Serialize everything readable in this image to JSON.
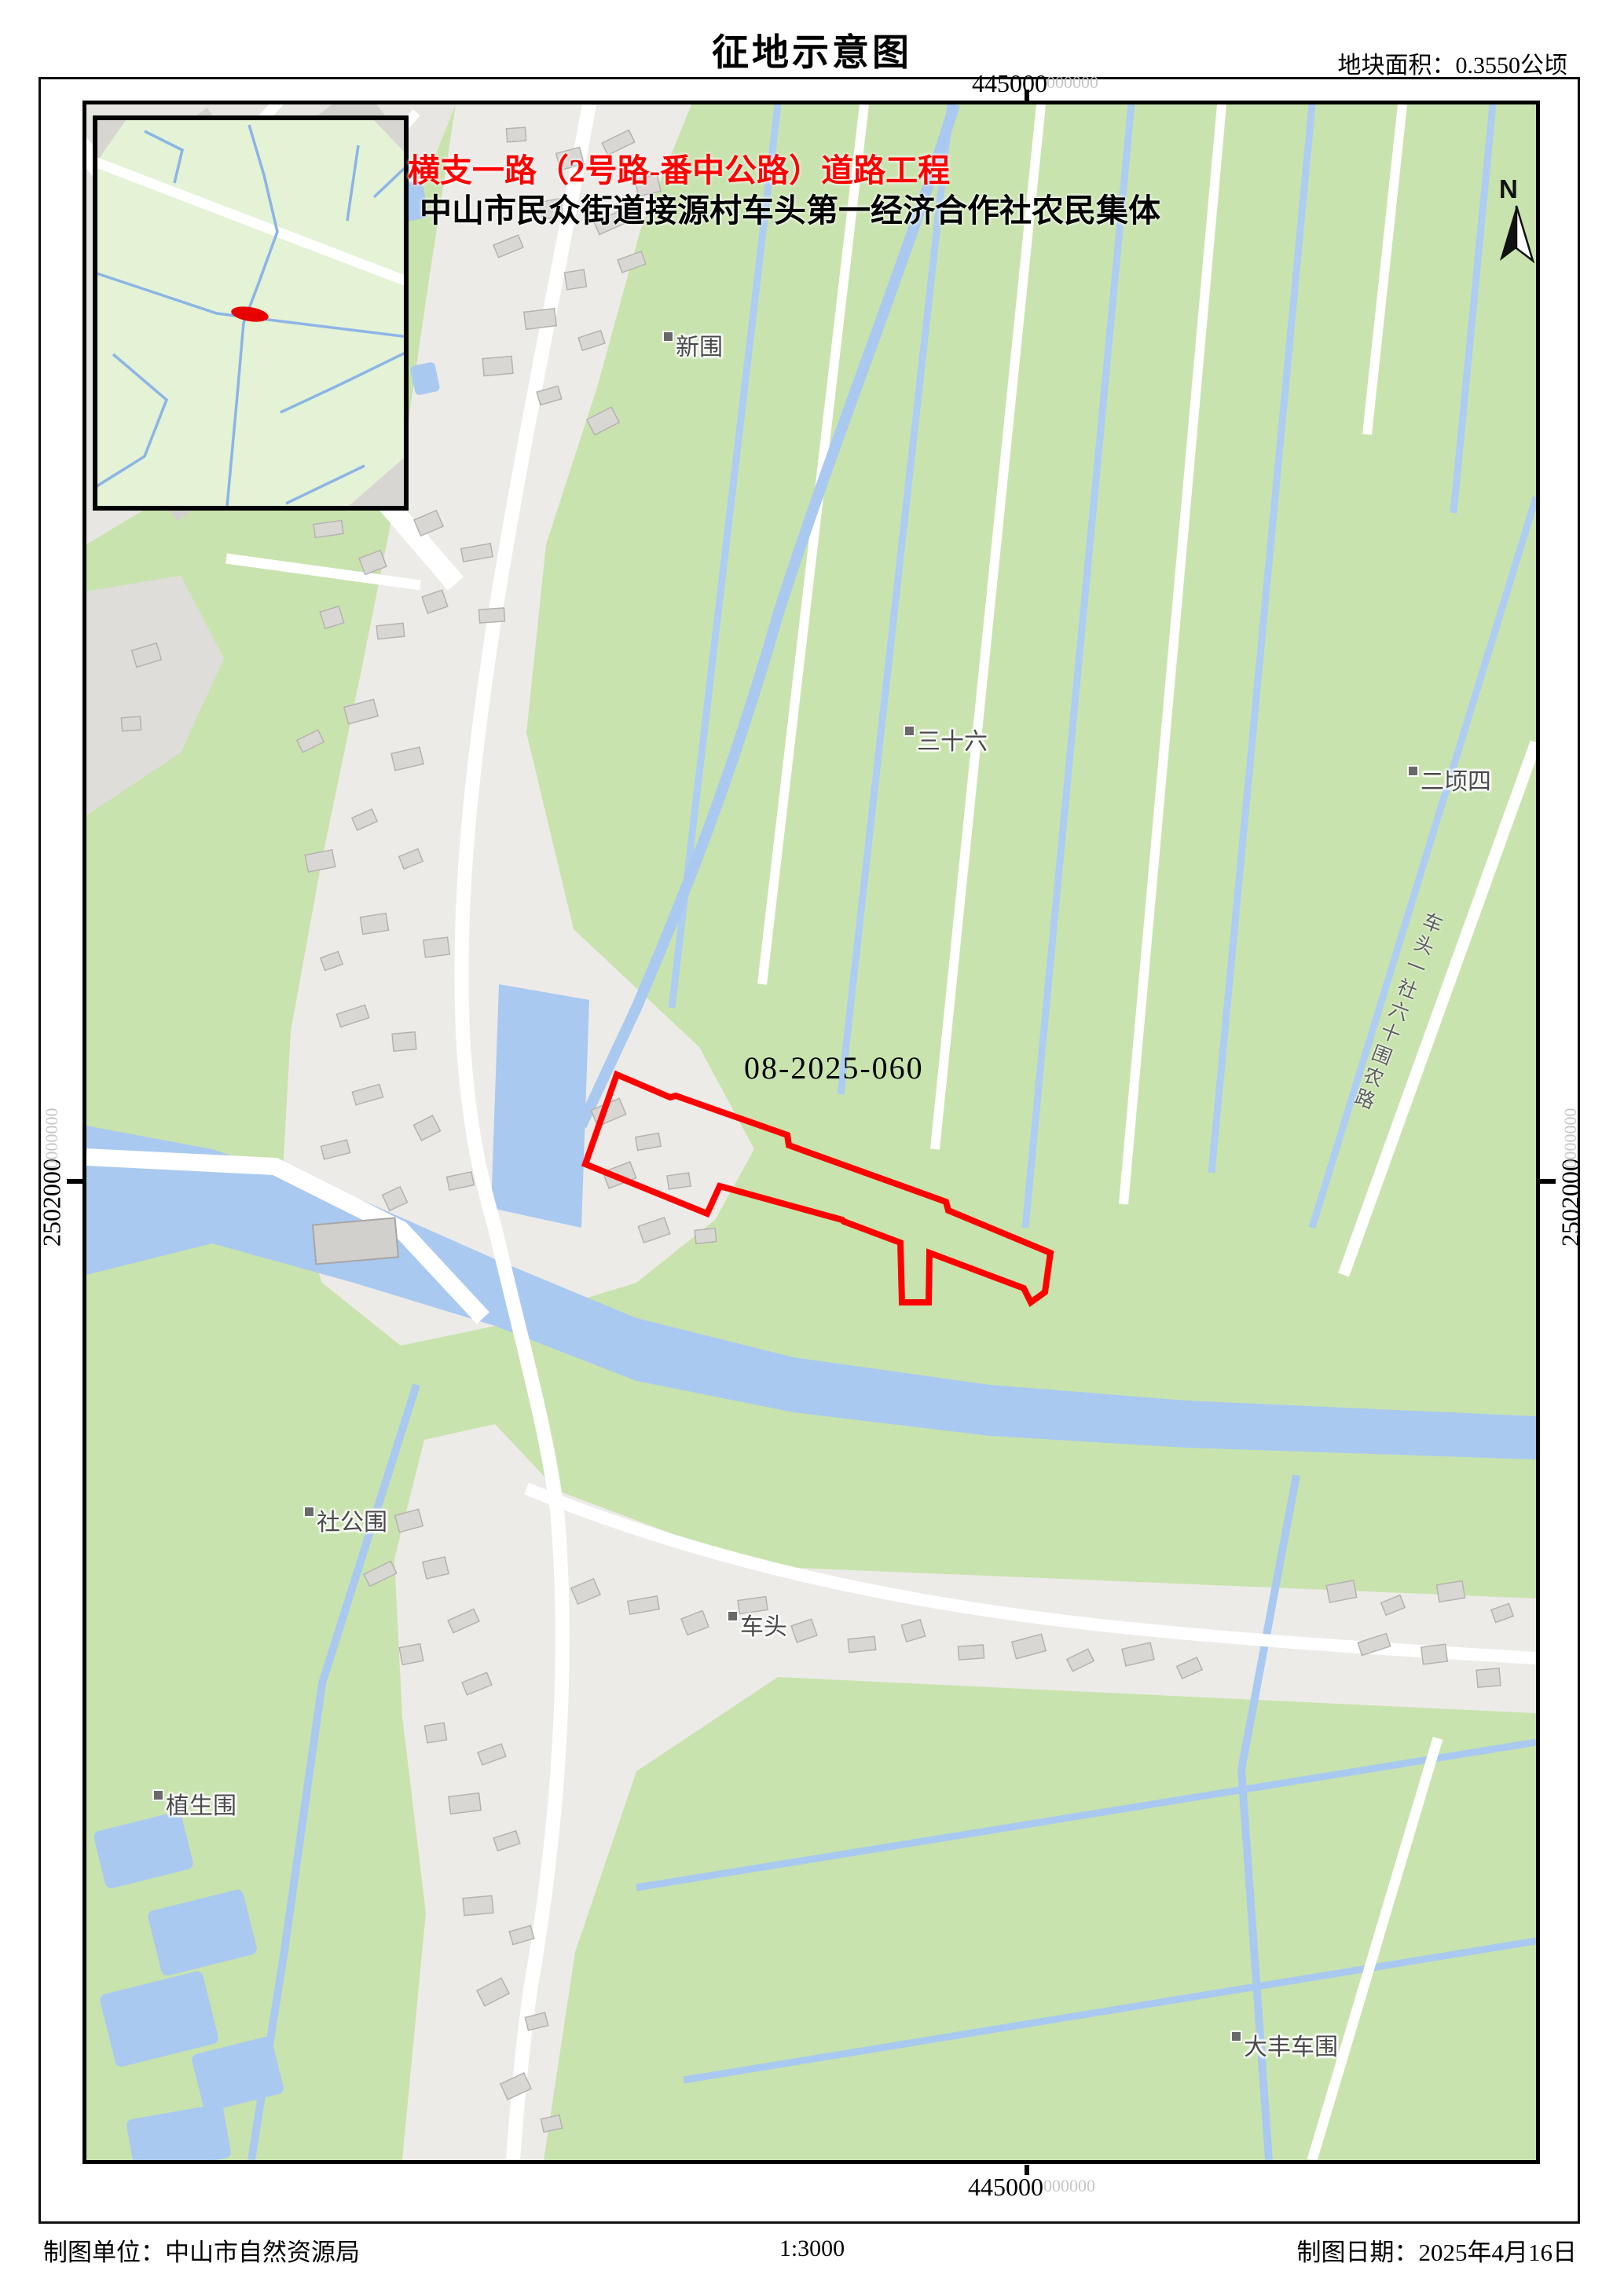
{
  "header": {
    "title": "征地示意图",
    "area_note": "地块面积：0.3550公顷"
  },
  "map": {
    "project_title": "横支一路（2号路-番中公路）道路工程",
    "project_subtitle": "中山市民众街道接源村车头第一经济合作社农民集体",
    "parcel_code": "08-2025-060",
    "north_label": "N",
    "road_name": "车头一社六十围农路",
    "place_labels": [
      {
        "name": "新围"
      },
      {
        "name": "三十六"
      },
      {
        "name": "二顷四"
      },
      {
        "name": "社公围"
      },
      {
        "name": "车头"
      },
      {
        "name": "植生围"
      },
      {
        "name": "大丰车围"
      }
    ],
    "coords": {
      "top_main": "445000",
      "top_sub": "000000",
      "bottom_main": "445000",
      "bottom_sub": "000000",
      "left_main": "2502000",
      "left_sub": "0000000",
      "right_main": "2502000",
      "right_sub": "0000000"
    },
    "colors": {
      "parcel_outline": "#ff0000",
      "project_title_red": "#ff0000",
      "field_green": "#c9e3ae",
      "water_blue": "#a9c9f0",
      "road_white": "#ffffff",
      "building_gray": "#d9d7d4",
      "label_gray": "#4a4a4a"
    }
  },
  "footer": {
    "agency": "制图单位：中山市自然资源局",
    "scale": "1:3000",
    "date": "制图日期：2025年4月16日"
  }
}
